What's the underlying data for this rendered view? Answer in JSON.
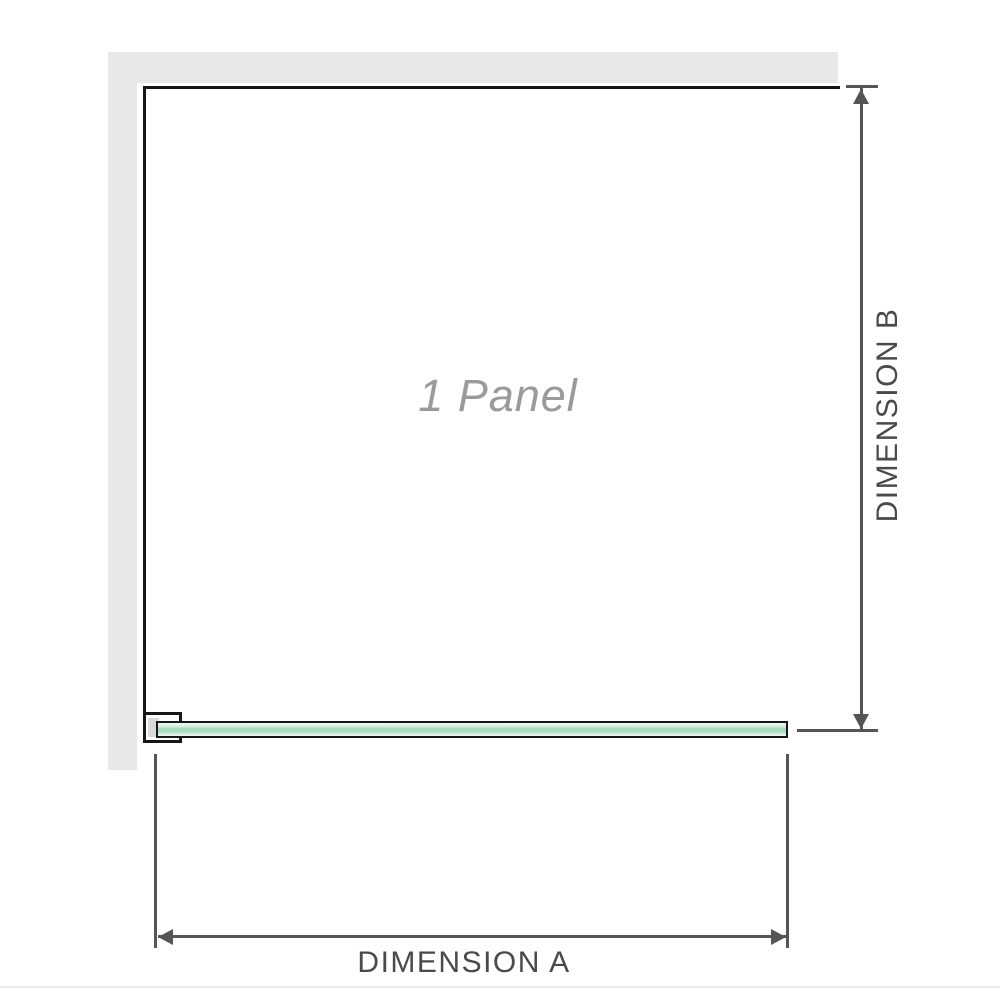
{
  "diagram": {
    "panel_label": "1 Panel",
    "dimension_a_label": "DIMENSION A",
    "dimension_b_label": "DIMENSION B"
  },
  "colors": {
    "wall": "#e8e8e8",
    "outline": "#161616",
    "dim-line": "#555555",
    "dim-text": "#4a4a4a",
    "panel-text": "#9a9a9a",
    "glass-light": "#eef8f1",
    "glass-mid": "#a6d8ba",
    "bracket-inner": "#d9d9d9",
    "baseline": "#e9e9e9"
  }
}
